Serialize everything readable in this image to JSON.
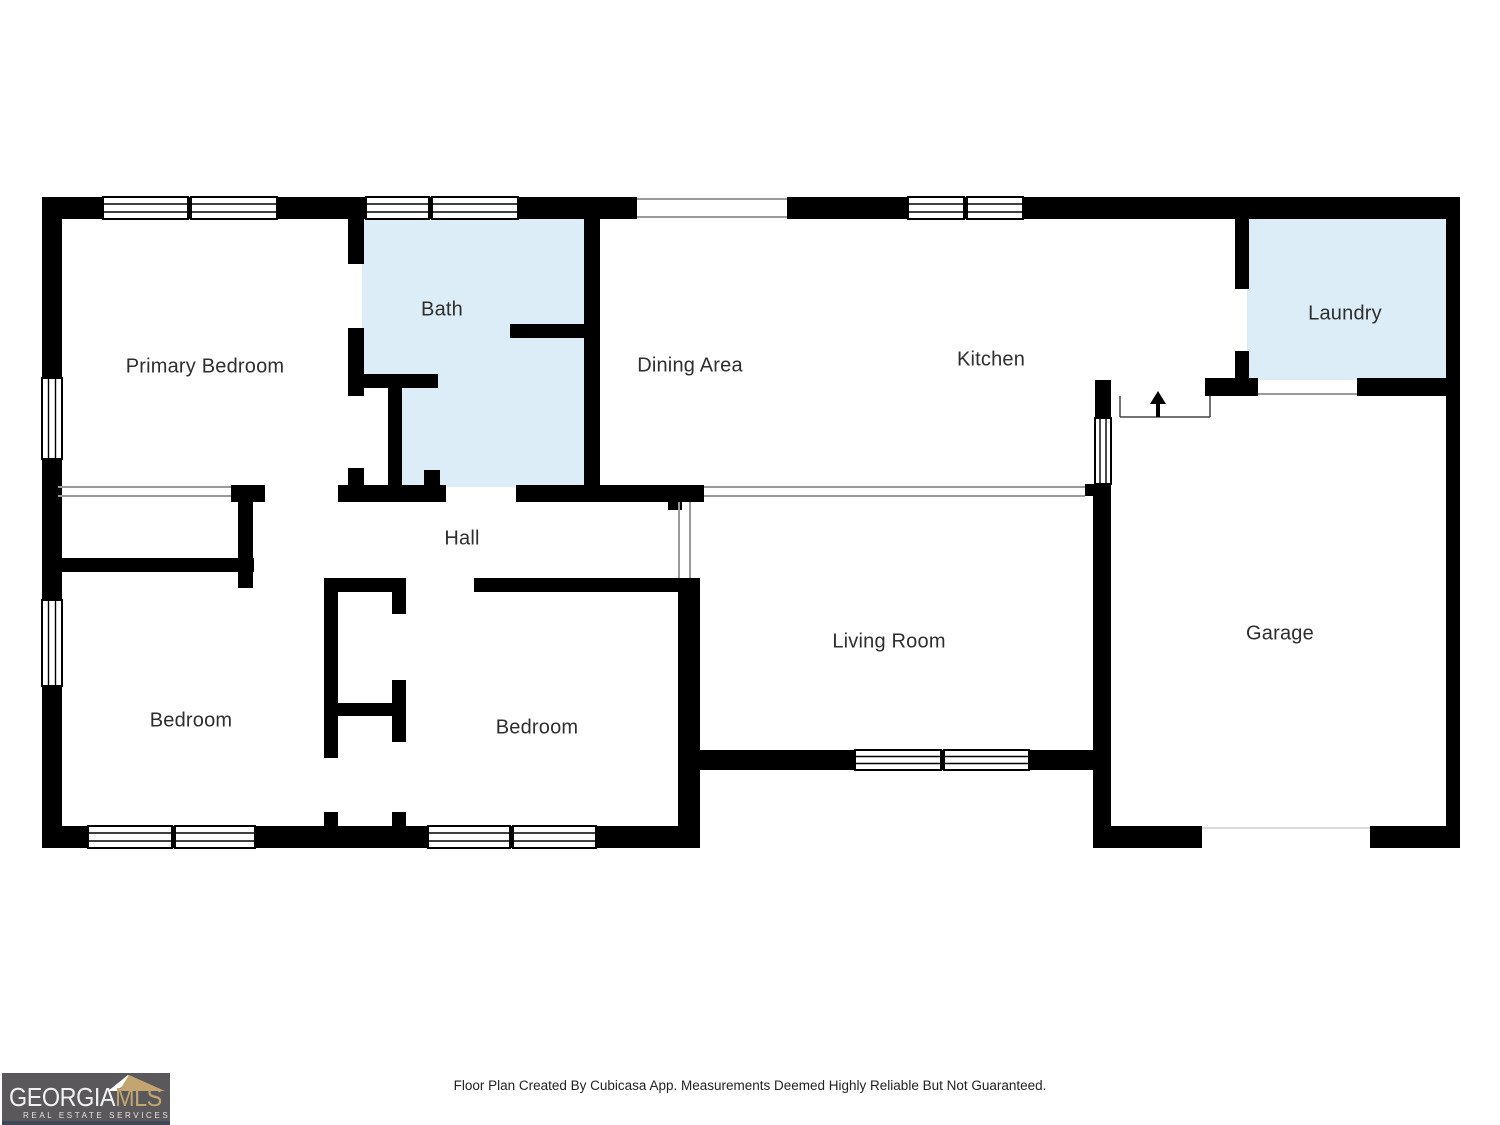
{
  "rooms": {
    "primary_bedroom": {
      "label": "Primary Bedroom"
    },
    "bath": {
      "label": "Bath"
    },
    "dining": {
      "label": "Dining Area"
    },
    "kitchen": {
      "label": "Kitchen"
    },
    "laundry": {
      "label": "Laundry"
    },
    "hall": {
      "label": "Hall"
    },
    "bedroom_left": {
      "label": "Bedroom"
    },
    "bedroom_middle": {
      "label": "Bedroom"
    },
    "living_room": {
      "label": "Living Room"
    },
    "garage": {
      "label": "Garage"
    }
  },
  "footer": {
    "disclaimer": "Floor Plan Created By Cubicasa App. Measurements Deemed Highly Reliable But Not Guaranteed."
  },
  "logo": {
    "brand_primary": "GEORGIA",
    "brand_secondary": "MLS",
    "tagline": "REAL ESTATE SERVICES"
  },
  "annotations": {
    "entry_arrow": "up-arrow"
  },
  "colors": {
    "wall": "#000000",
    "wet_room_fill": "#ddedf8",
    "thin_line": "#9a9a9a",
    "label_text": "#2e2e2e",
    "logo_background": "#5a585b",
    "logo_gold": "#c3a572",
    "logo_white": "#f2f2f2",
    "logo_strip": "#3f4757"
  }
}
